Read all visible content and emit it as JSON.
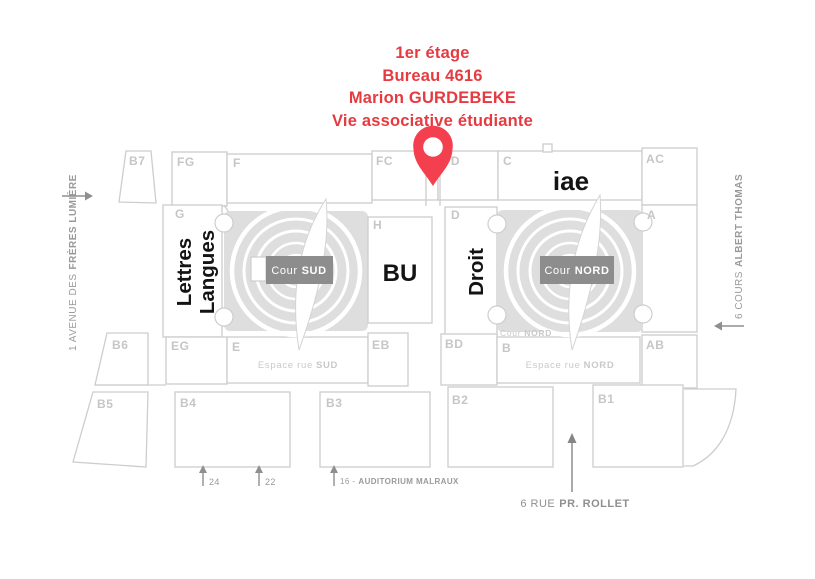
{
  "header": {
    "line1": "1er étage",
    "line2": "Bureau 4616",
    "line3": "Marion GURDEBEKE",
    "line4": "Vie associative étudiante"
  },
  "colors": {
    "accent_red": "#e63a41",
    "pin_red": "#f4404e",
    "block_stroke": "#cdcdcd",
    "court_gray": "#dedede"
  },
  "blocks": {
    "b7": "B7",
    "fg": "FG",
    "f": "F",
    "fc": "FC",
    "fd": "FD",
    "c": "C",
    "ac": "AC",
    "g": "G",
    "h": "H",
    "d": "D",
    "a": "A",
    "eg": "EG",
    "e": "E",
    "eb": "EB",
    "bd": "BD",
    "b": "B",
    "ab": "AB",
    "b6": "B6",
    "b5": "B5",
    "b4": "B4",
    "b3": "B3",
    "b2": "B2",
    "b1": "B1"
  },
  "buildings": {
    "iae": "iae",
    "bu": "BU",
    "droit": "Droit",
    "lettres_line1": "Lettres",
    "lettres_line2": "Langues"
  },
  "courtyards": {
    "sud": {
      "label": "Cour",
      "label_bold": "SUD"
    },
    "nord": {
      "label": "Cour",
      "label_bold": "NORD"
    },
    "nord_small": {
      "label": "Cour",
      "label_bold": "NORD"
    }
  },
  "espaces": {
    "sud": {
      "prefix": "Espace rue",
      "bold": "SUD"
    },
    "nord": {
      "prefix": "Espace rue",
      "bold": "NORD"
    }
  },
  "streets": {
    "left": {
      "prefix": "1 AVENUE DES",
      "bold": "FRÈRES LUMIÈRE"
    },
    "right": {
      "prefix": "6 COURS",
      "bold": "ALBERT THOMAS"
    },
    "bottom": {
      "prefix": "6 RUE",
      "bold": "PR. ROLLET"
    }
  },
  "entrances": {
    "e24": "24",
    "e22": "22",
    "e16_prefix": "16 -",
    "e16_bold": "AUDITORIUM MALRAUX"
  }
}
